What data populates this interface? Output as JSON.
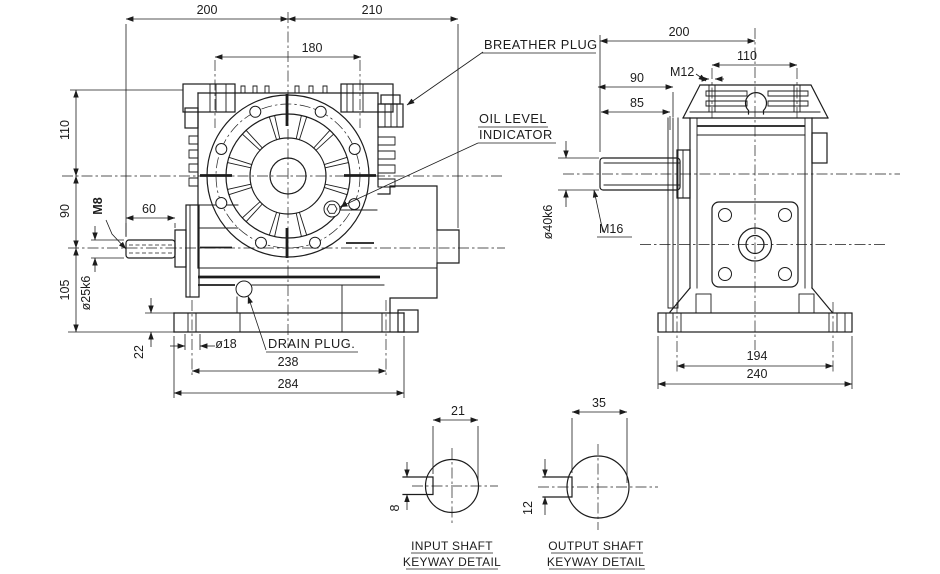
{
  "colors": {
    "line": "#1c1c1c",
    "background": "#ffffff"
  },
  "drawing": {
    "front_view": {
      "dim_overall_left": "200",
      "dim_overall_right": "210",
      "dim_bolt_spacing_top": "180",
      "dim_height_top": "110",
      "dim_height_mid": "90",
      "dim_height_bottom": "105",
      "dim_base_thickness": "22",
      "dim_shaft_length": "60",
      "thread_input": "M8",
      "dim_input_shaft": "ø25k6",
      "dim_foot_hole": "ø18",
      "dim_foot_spacing": "238",
      "dim_base_width": "284"
    },
    "callouts": {
      "breather_plug": "BREATHER PLUG",
      "oil_level_line1": "OIL LEVEL",
      "oil_level_line2": "INDICATOR",
      "drain_plug": "DRAIN PLUG."
    },
    "side_view": {
      "dim_overall": "200",
      "dim_bolt_spacing": "110",
      "thread_top": "M12",
      "dim_shaft_proj_top": "90",
      "dim_shaft_proj_bottom": "85",
      "thread_output": "M16",
      "dim_output_shaft": "ø40k6",
      "dim_foot_spacing": "194",
      "dim_base_width": "240"
    },
    "input_keyway": {
      "dim_across": "21",
      "dim_key_width": "8",
      "caption_line1": "INPUT SHAFT",
      "caption_line2": "KEYWAY DETAIL"
    },
    "output_keyway": {
      "dim_across": "35",
      "dim_key_width": "12",
      "caption_line1": "OUTPUT SHAFT",
      "caption_line2": "KEYWAY DETAIL"
    }
  }
}
